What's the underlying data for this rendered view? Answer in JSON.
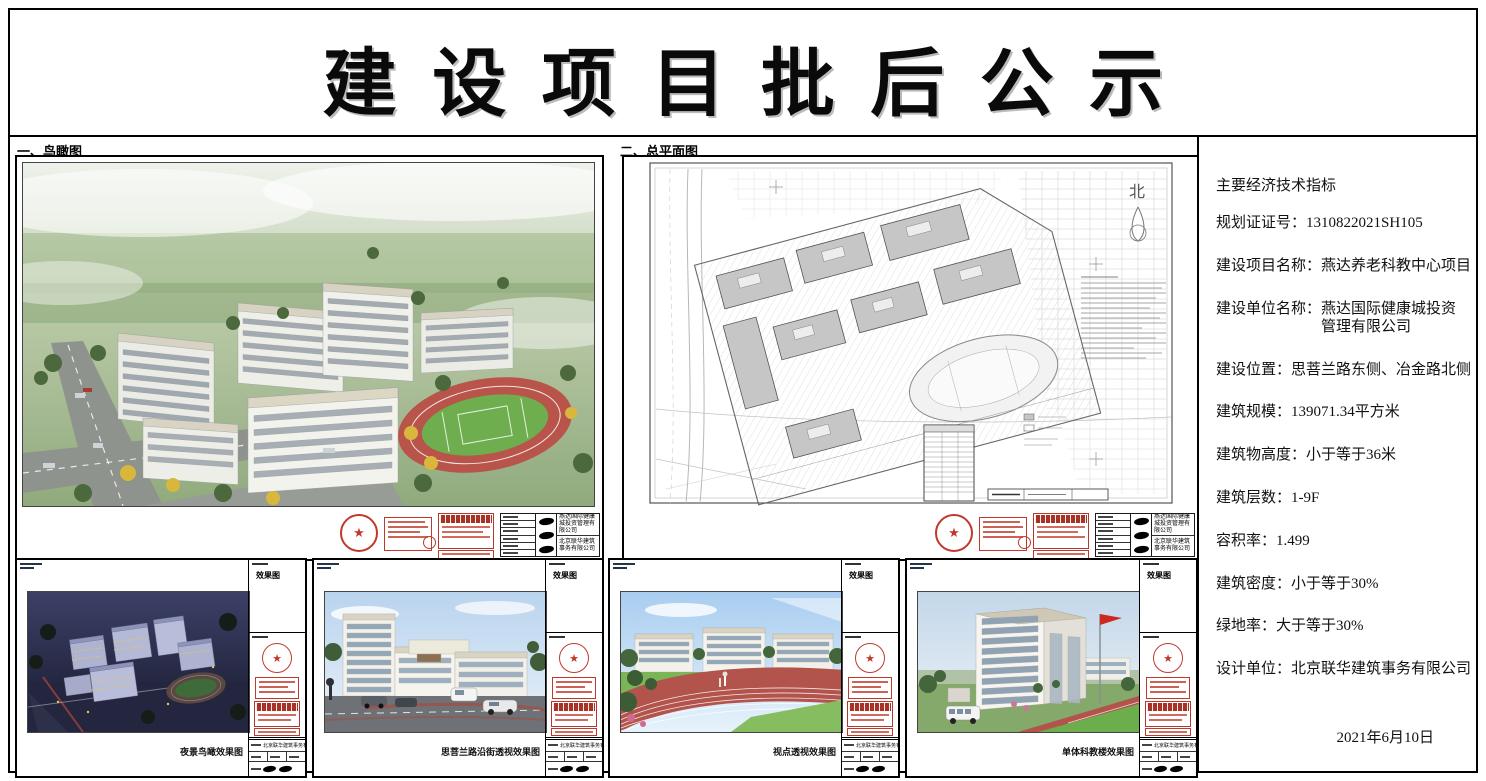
{
  "page": {
    "title": "建设项目批后公示",
    "date": "2021年6月10日"
  },
  "sections": {
    "aerial_label": "一、鸟瞰图",
    "siteplan_label": "二、总平面图",
    "north_label": "北"
  },
  "indicators": {
    "heading": "主要经济技术指标",
    "items": [
      {
        "label": "规划证证号：",
        "value": "1310822021SH105"
      },
      {
        "label": "建设项目名称：",
        "value": "燕达养老科教中心项目"
      },
      {
        "label": "建设单位名称：",
        "value": "燕达国际健康城投资管理有限公司"
      },
      {
        "label": "建设位置：",
        "value": "思菩兰路东侧、冶金路北侧"
      },
      {
        "label": "建筑规模：",
        "value": "139071.34平方米"
      },
      {
        "label": "建筑物高度：",
        "value": "小于等于36米"
      },
      {
        "label": "建筑层数：",
        "value": "1-9F"
      },
      {
        "label": "容积率：",
        "value": "1.499"
      },
      {
        "label": "建筑密度：",
        "value": "小于等于30%"
      },
      {
        "label": "绿地率：",
        "value": "大于等于30%"
      },
      {
        "label": "设计单位：",
        "value": "北京联华建筑事务有限公司"
      }
    ]
  },
  "titleblock": {
    "drawing_label": "效果图",
    "client_company": "燕达国际健康城投资管理有限公司",
    "design_company": "北京联华建筑事务有限公司"
  },
  "bottom_panels": [
    {
      "caption": "夜景鸟瞰效果图"
    },
    {
      "caption": "思菩兰路沿街透视效果图"
    },
    {
      "caption": "视点透视效果图"
    },
    {
      "caption": "单体科教楼效果图"
    }
  ]
}
